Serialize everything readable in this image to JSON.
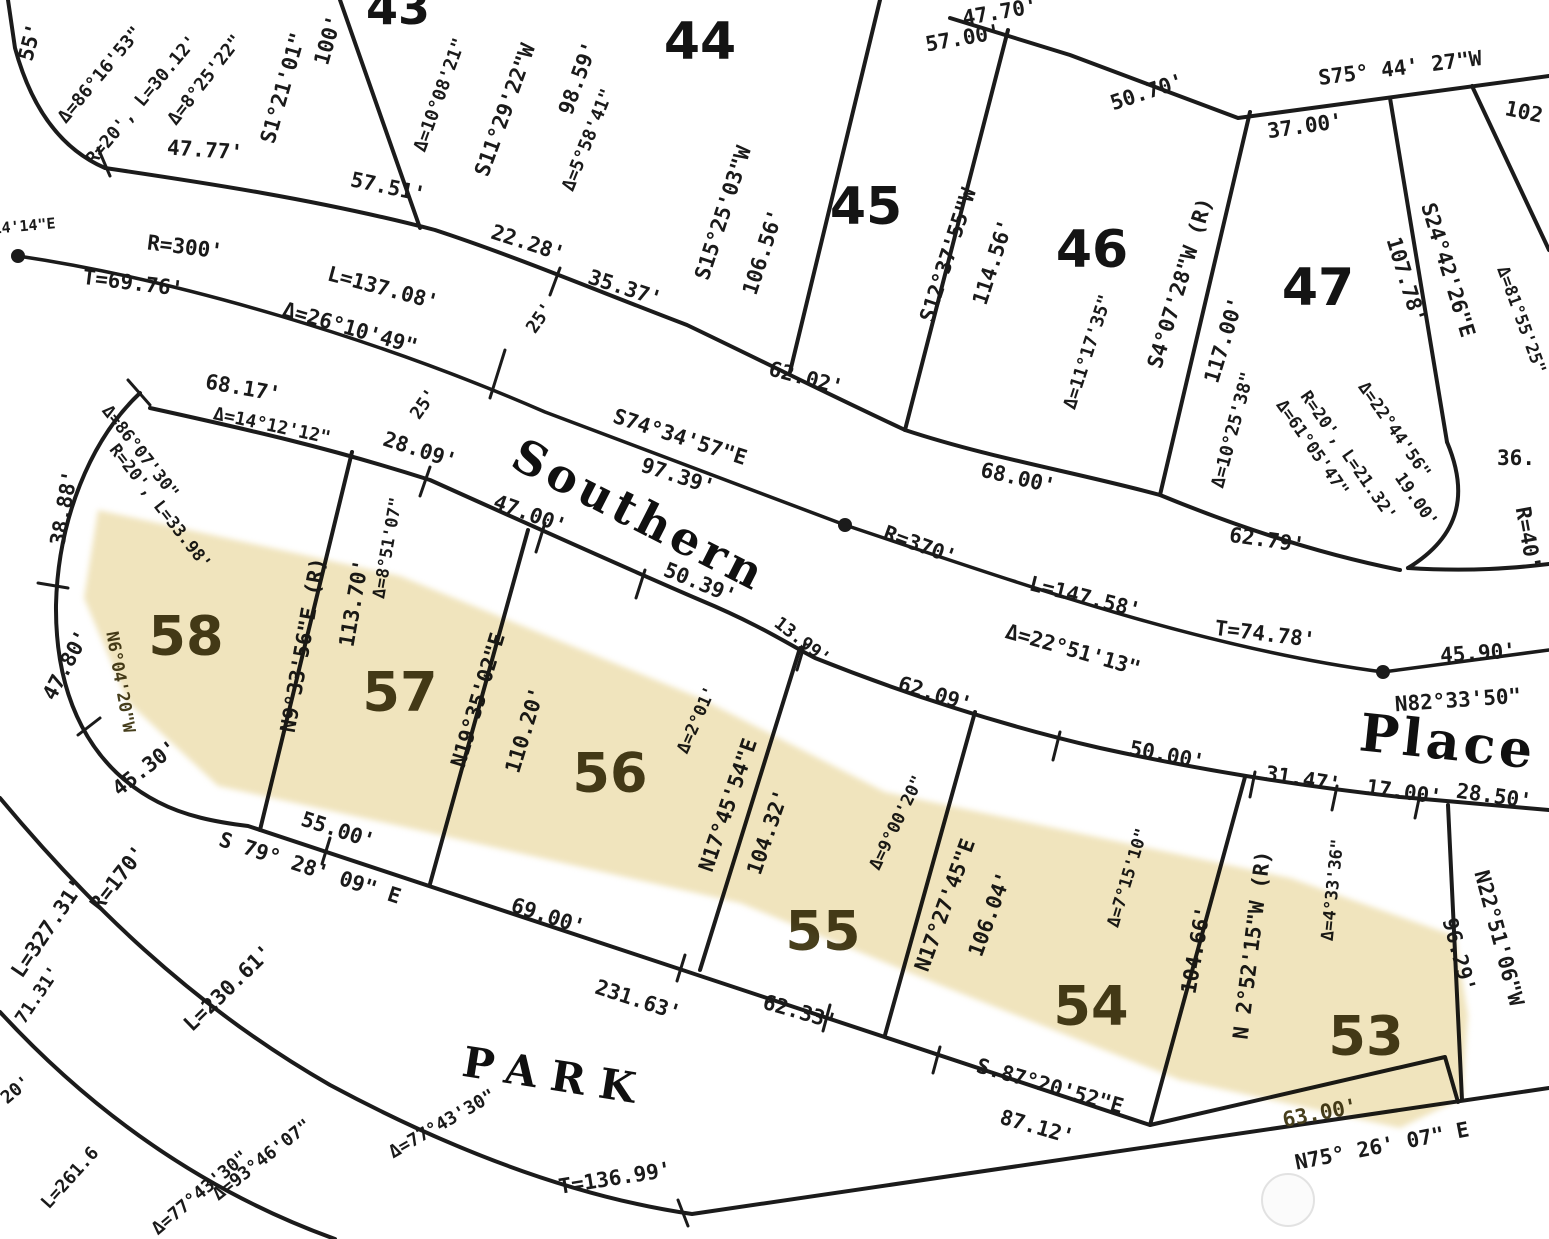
{
  "map": {
    "type": "subdivision plat (scanned survey map)",
    "street_names": [
      "Southern",
      "Place",
      "PARK"
    ],
    "highlighted_lots": [
      "58",
      "57",
      "56",
      "55",
      "54",
      "53"
    ],
    "colors": {
      "highlight": "#f0e4bd",
      "ink": "#1b1b1b",
      "highlighted_text": "#473f1d",
      "background": "#ffffff"
    },
    "lots": [
      {
        "number": "43",
        "x": 398,
        "y": 8,
        "s": 46,
        "hl": false
      },
      {
        "number": "44",
        "x": 700,
        "y": 42,
        "s": 52,
        "hl": false
      },
      {
        "number": "45",
        "x": 866,
        "y": 207,
        "s": 52,
        "hl": false
      },
      {
        "number": "46",
        "x": 1092,
        "y": 250,
        "s": 52,
        "hl": false
      },
      {
        "number": "47",
        "x": 1318,
        "y": 288,
        "s": 52,
        "hl": false
      },
      {
        "number": "58",
        "x": 186,
        "y": 636,
        "s": 54,
        "hl": true
      },
      {
        "number": "57",
        "x": 400,
        "y": 692,
        "s": 54,
        "hl": true
      },
      {
        "number": "56",
        "x": 610,
        "y": 773,
        "s": 54,
        "hl": true
      },
      {
        "number": "55",
        "x": 823,
        "y": 931,
        "s": 54,
        "hl": true
      },
      {
        "number": "54",
        "x": 1091,
        "y": 1006,
        "s": 54,
        "hl": true
      },
      {
        "number": "53",
        "x": 1366,
        "y": 1036,
        "s": 54,
        "hl": true
      }
    ],
    "labels": [
      {
        "t": "55'",
        "x": 30,
        "y": 42,
        "r": -75
      },
      {
        "t": "Δ=86°16'53\"",
        "x": 100,
        "y": 75,
        "r": -50,
        "s": 18
      },
      {
        "t": "R=20', L=30.12'",
        "x": 142,
        "y": 100,
        "r": -50,
        "s": 18
      },
      {
        "t": "Δ=8°25'22\"",
        "x": 205,
        "y": 80,
        "r": -52,
        "s": 18
      },
      {
        "t": "S1°21'01\"",
        "x": 283,
        "y": 88,
        "r": -74
      },
      {
        "t": "100'",
        "x": 328,
        "y": 40,
        "r": -74
      },
      {
        "t": "47.77'",
        "x": 205,
        "y": 150,
        "r": 4
      },
      {
        "t": "57.51'",
        "x": 388,
        "y": 187,
        "r": 12
      },
      {
        "t": "Δ=10°08'21\"",
        "x": 440,
        "y": 95,
        "r": -70,
        "s": 18
      },
      {
        "t": "S11°29'22\"W",
        "x": 505,
        "y": 110,
        "r": -70
      },
      {
        "t": "98.59'",
        "x": 578,
        "y": 78,
        "r": -70
      },
      {
        "t": "Δ=5°58'41\"",
        "x": 588,
        "y": 140,
        "r": -68,
        "s": 18
      },
      {
        "t": "22.28'",
        "x": 528,
        "y": 243,
        "r": 18
      },
      {
        "t": "35.37'",
        "x": 625,
        "y": 288,
        "r": 18
      },
      {
        "t": "25'",
        "x": 540,
        "y": 318,
        "r": -55,
        "s": 18
      },
      {
        "t": "25'",
        "x": 424,
        "y": 404,
        "r": -55,
        "s": 18
      },
      {
        "t": "S15°25'03\"W",
        "x": 723,
        "y": 213,
        "r": -72
      },
      {
        "t": "106.56'",
        "x": 763,
        "y": 252,
        "r": -72
      },
      {
        "t": "62.02'",
        "x": 806,
        "y": 378,
        "r": 15
      },
      {
        "t": "47.70'",
        "x": 1000,
        "y": 12,
        "r": -10
      },
      {
        "t": "57.00'",
        "x": 963,
        "y": 38,
        "r": -10
      },
      {
        "t": "50.70'",
        "x": 1147,
        "y": 92,
        "r": -18
      },
      {
        "t": "S75° 44' 27\"W",
        "x": 1400,
        "y": 68,
        "r": -7
      },
      {
        "t": "37.00'",
        "x": 1305,
        "y": 126,
        "r": -8
      },
      {
        "t": "102",
        "x": 1524,
        "y": 112,
        "r": 12
      },
      {
        "t": "S12°37'55\"W",
        "x": 948,
        "y": 255,
        "r": -72
      },
      {
        "t": "114.56'",
        "x": 993,
        "y": 262,
        "r": -72
      },
      {
        "t": "68.00'",
        "x": 1018,
        "y": 478,
        "r": 13
      },
      {
        "t": "Δ=11°17'35\"",
        "x": 1088,
        "y": 352,
        "r": -72,
        "s": 18
      },
      {
        "t": "S4°07'28\"W (R)",
        "x": 1180,
        "y": 283,
        "r": -73
      },
      {
        "t": "117.00'",
        "x": 1224,
        "y": 340,
        "r": -73
      },
      {
        "t": "Δ=10°25'38\"",
        "x": 1233,
        "y": 430,
        "r": -75,
        "s": 18
      },
      {
        "t": "62.79'",
        "x": 1267,
        "y": 540,
        "r": 8
      },
      {
        "t": "S24°42'26\"E",
        "x": 1448,
        "y": 270,
        "r": 73
      },
      {
        "t": "107.78'",
        "x": 1406,
        "y": 280,
        "r": 73
      },
      {
        "t": "Δ=81°55'25\"",
        "x": 1521,
        "y": 320,
        "r": 70,
        "s": 17
      },
      {
        "t": "Δ=61°05'47\"",
        "x": 1312,
        "y": 448,
        "r": 55,
        "s": 17
      },
      {
        "t": "R=20', L=21.32'",
        "x": 1348,
        "y": 456,
        "r": 55,
        "s": 17
      },
      {
        "t": "Δ=22°44'56\"",
        "x": 1394,
        "y": 430,
        "r": 55,
        "s": 17
      },
      {
        "t": "19.00'",
        "x": 1416,
        "y": 500,
        "r": 55,
        "s": 17
      },
      {
        "t": "36.",
        "x": 1516,
        "y": 458,
        "r": 0
      },
      {
        "t": "R=40'",
        "x": 1528,
        "y": 538,
        "r": 80
      },
      {
        "t": "14'14\"E",
        "x": 24,
        "y": 226,
        "r": -5,
        "s": 15
      },
      {
        "t": "R=300'",
        "x": 185,
        "y": 247,
        "r": 7
      },
      {
        "t": "T=69.76'",
        "x": 133,
        "y": 283,
        "r": 7
      },
      {
        "t": "L=137.08'",
        "x": 383,
        "y": 288,
        "r": 15
      },
      {
        "t": "Δ=26°10'49\"",
        "x": 350,
        "y": 328,
        "r": 16
      },
      {
        "t": "S74°34'57\"E",
        "x": 680,
        "y": 437,
        "r": 18
      },
      {
        "t": "97.39'",
        "x": 678,
        "y": 476,
        "r": 18
      },
      {
        "t": "Southern",
        "x": 640,
        "y": 515,
        "r": 27,
        "s": 46,
        "f": "name",
        "ls": 5
      },
      {
        "t": "R=370'",
        "x": 920,
        "y": 545,
        "r": 20
      },
      {
        "t": "L=147.58'",
        "x": 1085,
        "y": 597,
        "r": 14
      },
      {
        "t": "Δ=22°51'13\"",
        "x": 1073,
        "y": 650,
        "r": 16
      },
      {
        "t": "T=74.78'",
        "x": 1265,
        "y": 634,
        "r": 7
      },
      {
        "t": "45.90'",
        "x": 1478,
        "y": 653,
        "r": -4
      },
      {
        "t": "N82°33'50\"",
        "x": 1458,
        "y": 700,
        "r": -4
      },
      {
        "t": "Place",
        "x": 1448,
        "y": 742,
        "r": 6,
        "s": 52,
        "f": "name",
        "ls": 4
      },
      {
        "t": "28.09'",
        "x": 420,
        "y": 450,
        "r": 18
      },
      {
        "t": "Δ=8°51'07\"",
        "x": 388,
        "y": 548,
        "r": -80,
        "s": 17
      },
      {
        "t": "47.00'",
        "x": 530,
        "y": 514,
        "r": 20
      },
      {
        "t": "50.39'",
        "x": 700,
        "y": 583,
        "r": 22
      },
      {
        "t": "13.99'",
        "x": 802,
        "y": 641,
        "r": 38,
        "s": 18
      },
      {
        "t": "Δ=2°01'",
        "x": 697,
        "y": 720,
        "r": -66,
        "s": 17
      },
      {
        "t": "62.09'",
        "x": 935,
        "y": 694,
        "r": 17
      },
      {
        "t": "Δ=9°00'20\"",
        "x": 897,
        "y": 823,
        "r": -64,
        "s": 17
      },
      {
        "t": "50.00'",
        "x": 1167,
        "y": 755,
        "r": 11
      },
      {
        "t": "31.47'",
        "x": 1303,
        "y": 779,
        "r": 9
      },
      {
        "t": "17.00'",
        "x": 1404,
        "y": 792,
        "r": 8
      },
      {
        "t": "28.50'",
        "x": 1494,
        "y": 796,
        "r": 8
      },
      {
        "t": "N9°33'56\"E (R)",
        "x": 303,
        "y": 645,
        "r": -80
      },
      {
        "t": "113.70'",
        "x": 354,
        "y": 603,
        "r": -80
      },
      {
        "t": "N19°35'02\"E",
        "x": 478,
        "y": 700,
        "r": -73
      },
      {
        "t": "110.20'",
        "x": 525,
        "y": 730,
        "r": -73
      },
      {
        "t": "N17°45'54\"E",
        "x": 728,
        "y": 805,
        "r": -71
      },
      {
        "t": "104.32'",
        "x": 768,
        "y": 832,
        "r": -71
      },
      {
        "t": "N17°27'45\"E",
        "x": 945,
        "y": 905,
        "r": -70
      },
      {
        "t": "106.04'",
        "x": 990,
        "y": 914,
        "r": -70
      },
      {
        "t": "Δ=7°15'10\"",
        "x": 1128,
        "y": 878,
        "r": -73,
        "s": 17
      },
      {
        "t": "104.66'",
        "x": 1196,
        "y": 950,
        "r": -80
      },
      {
        "t": "N 2°52'15\"W (R)",
        "x": 1252,
        "y": 945,
        "r": -83
      },
      {
        "t": "Δ=4°33'36\"",
        "x": 1333,
        "y": 890,
        "r": -84,
        "s": 17
      },
      {
        "t": "N22°51'06\"W",
        "x": 1499,
        "y": 938,
        "r": 75
      },
      {
        "t": "96.29'",
        "x": 1459,
        "y": 955,
        "r": 75
      },
      {
        "t": "68.17'",
        "x": 243,
        "y": 388,
        "r": 10
      },
      {
        "t": "Δ=14°12'12\"",
        "x": 272,
        "y": 426,
        "r": 12,
        "s": 18
      },
      {
        "t": "Δ=86°07'30\"",
        "x": 140,
        "y": 452,
        "r": 52,
        "s": 17
      },
      {
        "t": "R=20', L=33.98'",
        "x": 160,
        "y": 507,
        "r": 52,
        "s": 17
      },
      {
        "t": "38.88'",
        "x": 64,
        "y": 508,
        "r": -80
      },
      {
        "t": "47.80'",
        "x": 66,
        "y": 665,
        "r": -62
      },
      {
        "t": "N6°04'20\"W",
        "x": 120,
        "y": 682,
        "r": 80,
        "s": 17,
        "c": "olive"
      },
      {
        "t": "45.30'",
        "x": 145,
        "y": 768,
        "r": -38
      },
      {
        "t": "55.00'",
        "x": 338,
        "y": 830,
        "r": 18
      },
      {
        "t": "S 79° 28' 09\" E",
        "x": 310,
        "y": 868,
        "r": 18
      },
      {
        "t": "69.00'",
        "x": 548,
        "y": 916,
        "r": 18
      },
      {
        "t": "231.63'",
        "x": 638,
        "y": 1000,
        "r": 18
      },
      {
        "t": "62.33'",
        "x": 800,
        "y": 1012,
        "r": 16
      },
      {
        "t": "S.87°20'52\"E",
        "x": 1050,
        "y": 1086,
        "r": 16
      },
      {
        "t": "87.12'",
        "x": 1037,
        "y": 1127,
        "r": 16
      },
      {
        "t": "63.00'",
        "x": 1320,
        "y": 1113,
        "r": -11,
        "c": "olive"
      },
      {
        "t": "N75° 26' 07\" E",
        "x": 1382,
        "y": 1146,
        "r": -11
      },
      {
        "t": "PARK",
        "x": 556,
        "y": 1076,
        "r": 9,
        "s": 42,
        "f": "name",
        "ls": 14
      },
      {
        "t": "R=170'",
        "x": 118,
        "y": 878,
        "r": -52
      },
      {
        "t": "L=230.61'",
        "x": 228,
        "y": 988,
        "r": -44
      },
      {
        "t": "Δ=77°43'30\"",
        "x": 442,
        "y": 1124,
        "r": -30,
        "s": 18
      },
      {
        "t": "T=136.99'",
        "x": 615,
        "y": 1178,
        "r": -9
      },
      {
        "t": "L=327.31'",
        "x": 48,
        "y": 928,
        "r": -56
      },
      {
        "t": "71.31'",
        "x": 38,
        "y": 995,
        "r": -56,
        "s": 18
      },
      {
        "t": "Δ=93°46'07\"",
        "x": 262,
        "y": 1160,
        "r": -38,
        "s": 18
      },
      {
        "t": "Δ=77°43'30\"",
        "x": 200,
        "y": 1193,
        "r": -40,
        "s": 18
      },
      {
        "t": "L=261.6",
        "x": 70,
        "y": 1178,
        "r": -48,
        "s": 18
      },
      {
        "t": "20'",
        "x": 16,
        "y": 1090,
        "r": -40,
        "s": 18
      }
    ]
  }
}
